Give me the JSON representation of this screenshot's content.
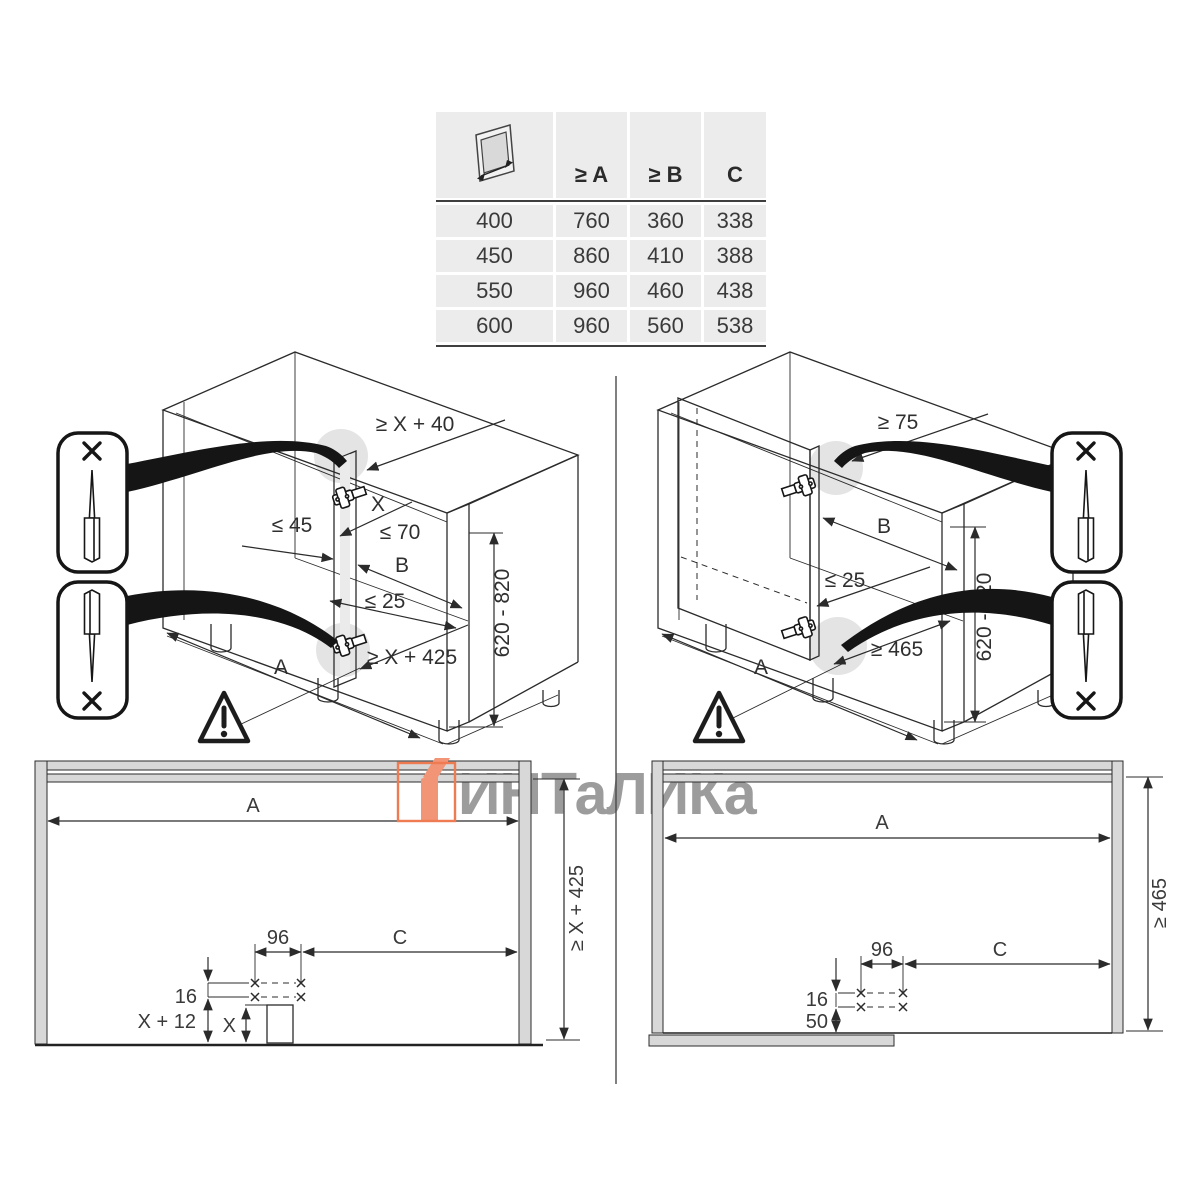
{
  "table": {
    "headers": [
      "≥ A",
      "≥ B",
      "C"
    ],
    "rows": [
      {
        "door": "400",
        "a": "760",
        "b": "360",
        "c": "338"
      },
      {
        "door": "450",
        "a": "860",
        "b": "410",
        "c": "388"
      },
      {
        "door": "550",
        "a": "960",
        "b": "460",
        "c": "438"
      },
      {
        "door": "600",
        "a": "960",
        "b": "560",
        "c": "538"
      }
    ]
  },
  "left_cabinet": {
    "top_gap": "≥ X + 40",
    "x_zone": "X",
    "le70": "≤ 70",
    "le45": "≤ 45",
    "b": "B",
    "le25": "≤ 25",
    "bottom_gap": "≥ X + 425",
    "a": "A",
    "height_range": "620 - 820"
  },
  "right_cabinet": {
    "top_gap": "≥ 75",
    "b": "B",
    "le25": "≤ 25",
    "bottom_gap": "≥ 465",
    "a": "A",
    "height_range": "620 - 820"
  },
  "front_view_left": {
    "a": "A",
    "height": "≥ X + 425",
    "hole_pitch": "96",
    "c": "C",
    "row_gap": "16",
    "offset": "X + 12",
    "obstacle_height": "X"
  },
  "front_view_right": {
    "a": "A",
    "height": "≥ 465",
    "hole_pitch": "96",
    "c": "C",
    "row_gap": "16",
    "plinth_gap": "50"
  },
  "watermark": {
    "text": "ИНТаЛИКа",
    "accent_color": "#EF7B52",
    "text_color": "#9C9C9C"
  }
}
